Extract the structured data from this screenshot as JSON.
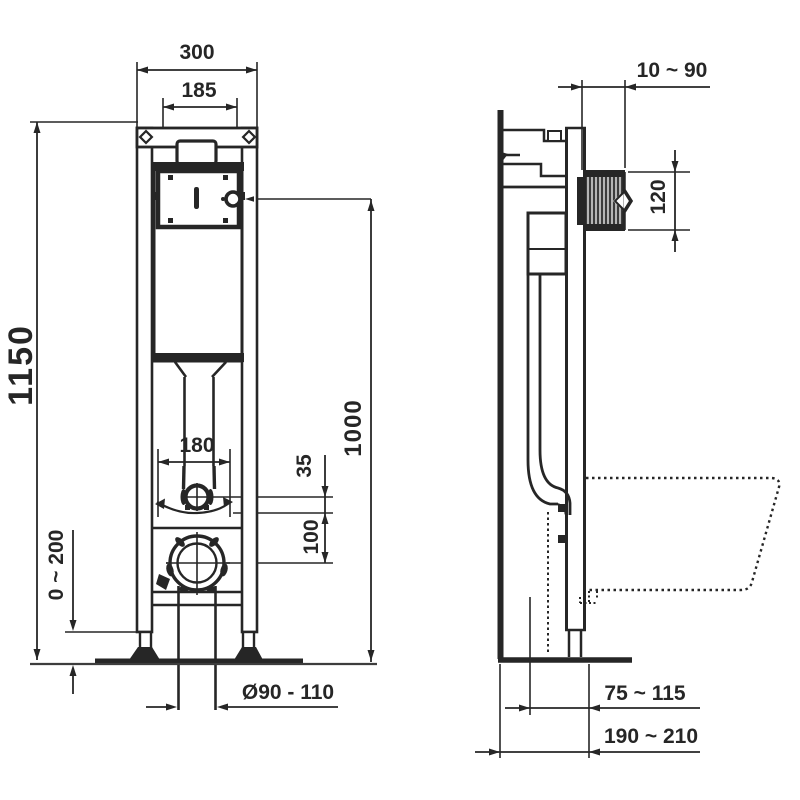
{
  "front_view": {
    "width_overall": "300",
    "flush_plate_width": "185",
    "frame_height": "1150",
    "flush_pipe_spacing": "180",
    "flush_panel_center_height": "1000",
    "supply_offset": "35",
    "supply_to_drain": "100",
    "foot_adjustment": "0 ~ 200",
    "drain_diameter": "Ø90 - 110"
  },
  "side_view": {
    "wall_finish_range": "10 ~ 90",
    "flush_plate_height": "120",
    "drain_to_wall": "75 ~ 115",
    "frame_depth": "190 ~ 210"
  },
  "colors": {
    "background": "#ffffff",
    "line": "#262626",
    "floor_line": "#3d3d3d",
    "hatch_bg": "#b5b5b5",
    "hatch_stripe": "#3c3c3c"
  }
}
